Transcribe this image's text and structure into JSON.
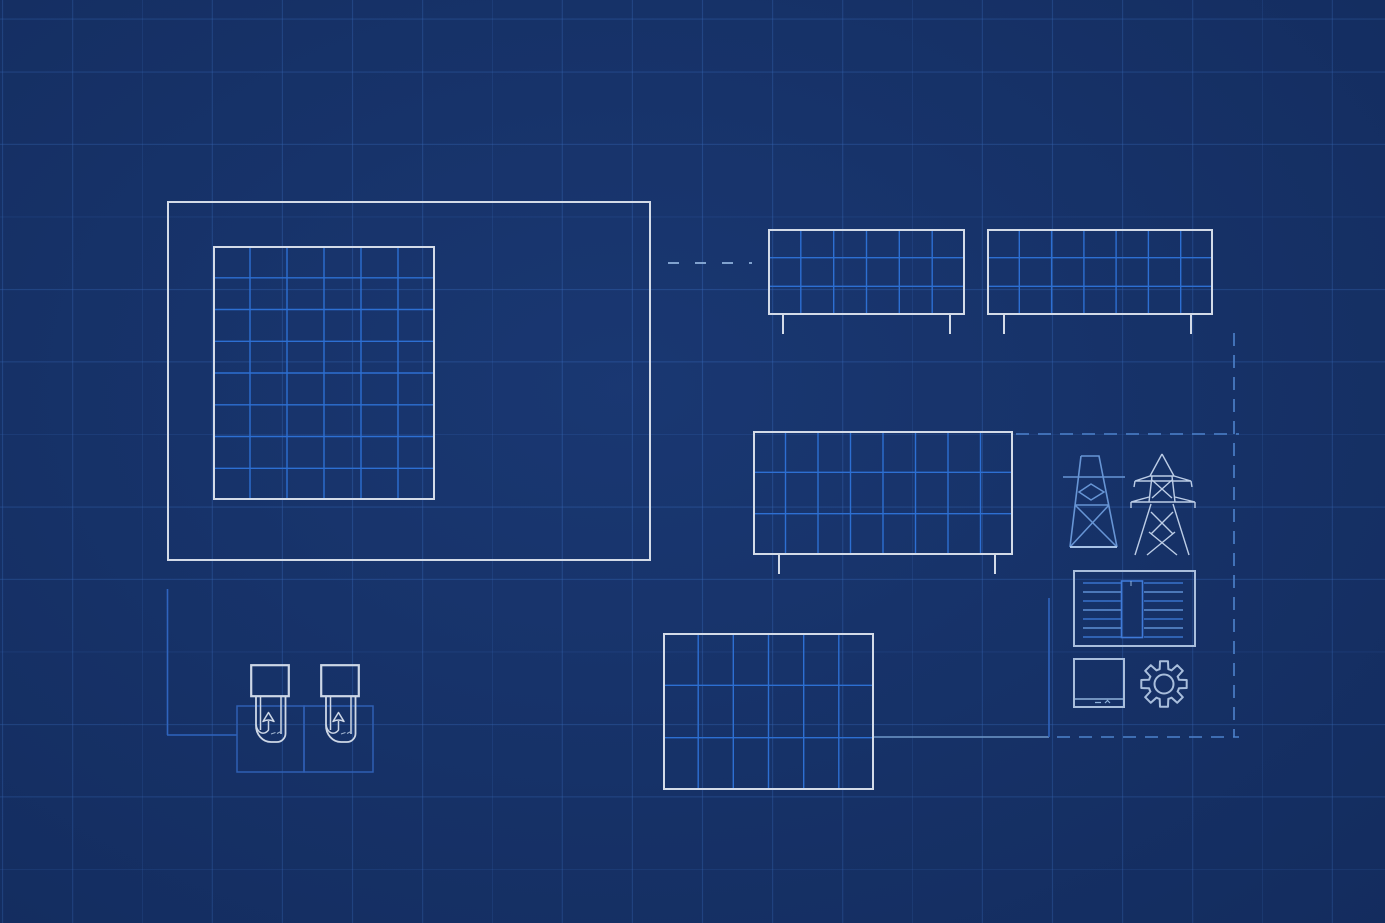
{
  "colors": {
    "background": "#163269",
    "grid_line": "rgba(56,108,190,0.40)",
    "frame_white": "#d3dbe8",
    "cell_line": "#2d6fd2",
    "dash_light": "#8fb2dc",
    "dash_blue": "#4d82cc",
    "feed_blue": "#2f64be",
    "feed_light": "#6f98c8",
    "bay_line": "#2e5fb4",
    "tower_blue": "#6795d5",
    "tower_base": "#a7c2e6",
    "tower_light": "#bccde6",
    "equip_frame": "#a9bedc",
    "equip_detail": "#8fb2dc",
    "winding_a": "#3873cc",
    "winding_b": "#5e90d4",
    "mid_rect": "#3f7ad8",
    "charger_line": "#cdd7e6"
  },
  "canvas": {
    "width": 1385,
    "height": 923,
    "grid_spacing_x": 70,
    "grid_spacing_y": 72.5
  },
  "layout": {
    "site-boundary": {
      "x": 167,
      "y": 201,
      "w": 484,
      "h": 360
    },
    "main-array": {
      "x": 213,
      "y": 246,
      "w": 222,
      "h": 254
    },
    "panel-top-left": {
      "x": 768,
      "y": 229,
      "w": 197,
      "h": 86
    },
    "panel-top-right": {
      "x": 987,
      "y": 229,
      "w": 226,
      "h": 86
    },
    "panel-mid": {
      "x": 753,
      "y": 431,
      "w": 260,
      "h": 124
    },
    "panel-bottom": {
      "x": 663,
      "y": 633,
      "w": 211,
      "h": 157
    },
    "transmission-tower-a": {
      "x": 1062,
      "y": 452,
      "w": 64,
      "h": 102
    },
    "transmission-tower-b": {
      "x": 1130,
      "y": 450,
      "w": 66,
      "h": 107
    },
    "transformer": {
      "x": 1073,
      "y": 570,
      "w": 123,
      "h": 77
    },
    "control-unit": {
      "x": 1073,
      "y": 658,
      "w": 52,
      "h": 50
    },
    "gear": {
      "x": 1140,
      "y": 660,
      "w": 48,
      "h": 48
    },
    "ev-charger-1": {
      "x": 250,
      "y": 664,
      "w": 40,
      "h": 82
    },
    "ev-charger-2": {
      "x": 320,
      "y": 664,
      "w": 40,
      "h": 82
    }
  },
  "panel_grids": {
    "main-array": {
      "cols": 6,
      "rows": 8,
      "legs": [],
      "leg_h": 0
    },
    "panel-top-left": {
      "cols": 6,
      "rows": 3,
      "legs": [
        783,
        950
      ],
      "leg_h": 19
    },
    "panel-top-right": {
      "cols": 7,
      "rows": 3,
      "legs": [
        1004,
        1191
      ],
      "leg_h": 19
    },
    "panel-mid": {
      "cols": 8,
      "rows": 3,
      "legs": [
        779,
        995
      ],
      "leg_h": 19
    },
    "panel-bottom": {
      "cols": 6,
      "rows": 3,
      "legs": [],
      "leg_h": 0
    }
  },
  "connectors": [
    {
      "name": "array-to-panels-dash",
      "x1": 668,
      "y1": 263,
      "x2": 752,
      "y2": 263,
      "color": "dash_light",
      "dash": "11 16",
      "w": 1.7
    },
    {
      "name": "grid-dash-top",
      "x1": 1016,
      "y1": 434,
      "x2": 1239,
      "y2": 434,
      "color": "dash_blue",
      "dash": "13 9",
      "w": 1.6
    },
    {
      "name": "grid-dash-right",
      "x1": 1234,
      "y1": 333,
      "x2": 1234,
      "y2": 737,
      "color": "dash_blue",
      "dash": "13 9",
      "w": 1.6
    },
    {
      "name": "grid-dash-bottom",
      "x1": 1057,
      "y1": 737,
      "x2": 1239,
      "y2": 737,
      "color": "dash_blue",
      "dash": "13 9",
      "w": 1.6
    },
    {
      "name": "feeder-left-vertical",
      "x1": 167.5,
      "y1": 589,
      "x2": 167.5,
      "y2": 735,
      "color": "feed_blue",
      "dash": "",
      "w": 1.6
    },
    {
      "name": "feeder-left-horizontal",
      "x1": 167,
      "y1": 735,
      "x2": 237,
      "y2": 735,
      "color": "feed_blue",
      "dash": "",
      "w": 1.6
    },
    {
      "name": "feeder-right-horizontal",
      "x1": 874,
      "y1": 737,
      "x2": 1049,
      "y2": 737,
      "color": "feed_light",
      "dash": "",
      "w": 1.6
    },
    {
      "name": "feeder-right-vertical",
      "x1": 1049,
      "y1": 598,
      "x2": 1049,
      "y2": 737,
      "color": "feed_blue",
      "dash": "",
      "w": 1.6
    }
  ],
  "charging_bays": [
    {
      "name": "charging-bay-1",
      "x": 237,
      "y": 706,
      "w": 67,
      "h": 66
    },
    {
      "name": "charging-bay-2",
      "x": 304,
      "y": 706,
      "w": 69,
      "h": 66
    }
  ],
  "equipment": {
    "transformer": {
      "winding_lines_per_side": 7,
      "line_spacing": 9,
      "first_line_y": 13,
      "left_x1": 10,
      "left_x2": 48,
      "right_x1": 71,
      "right_x2": 110
    }
  }
}
